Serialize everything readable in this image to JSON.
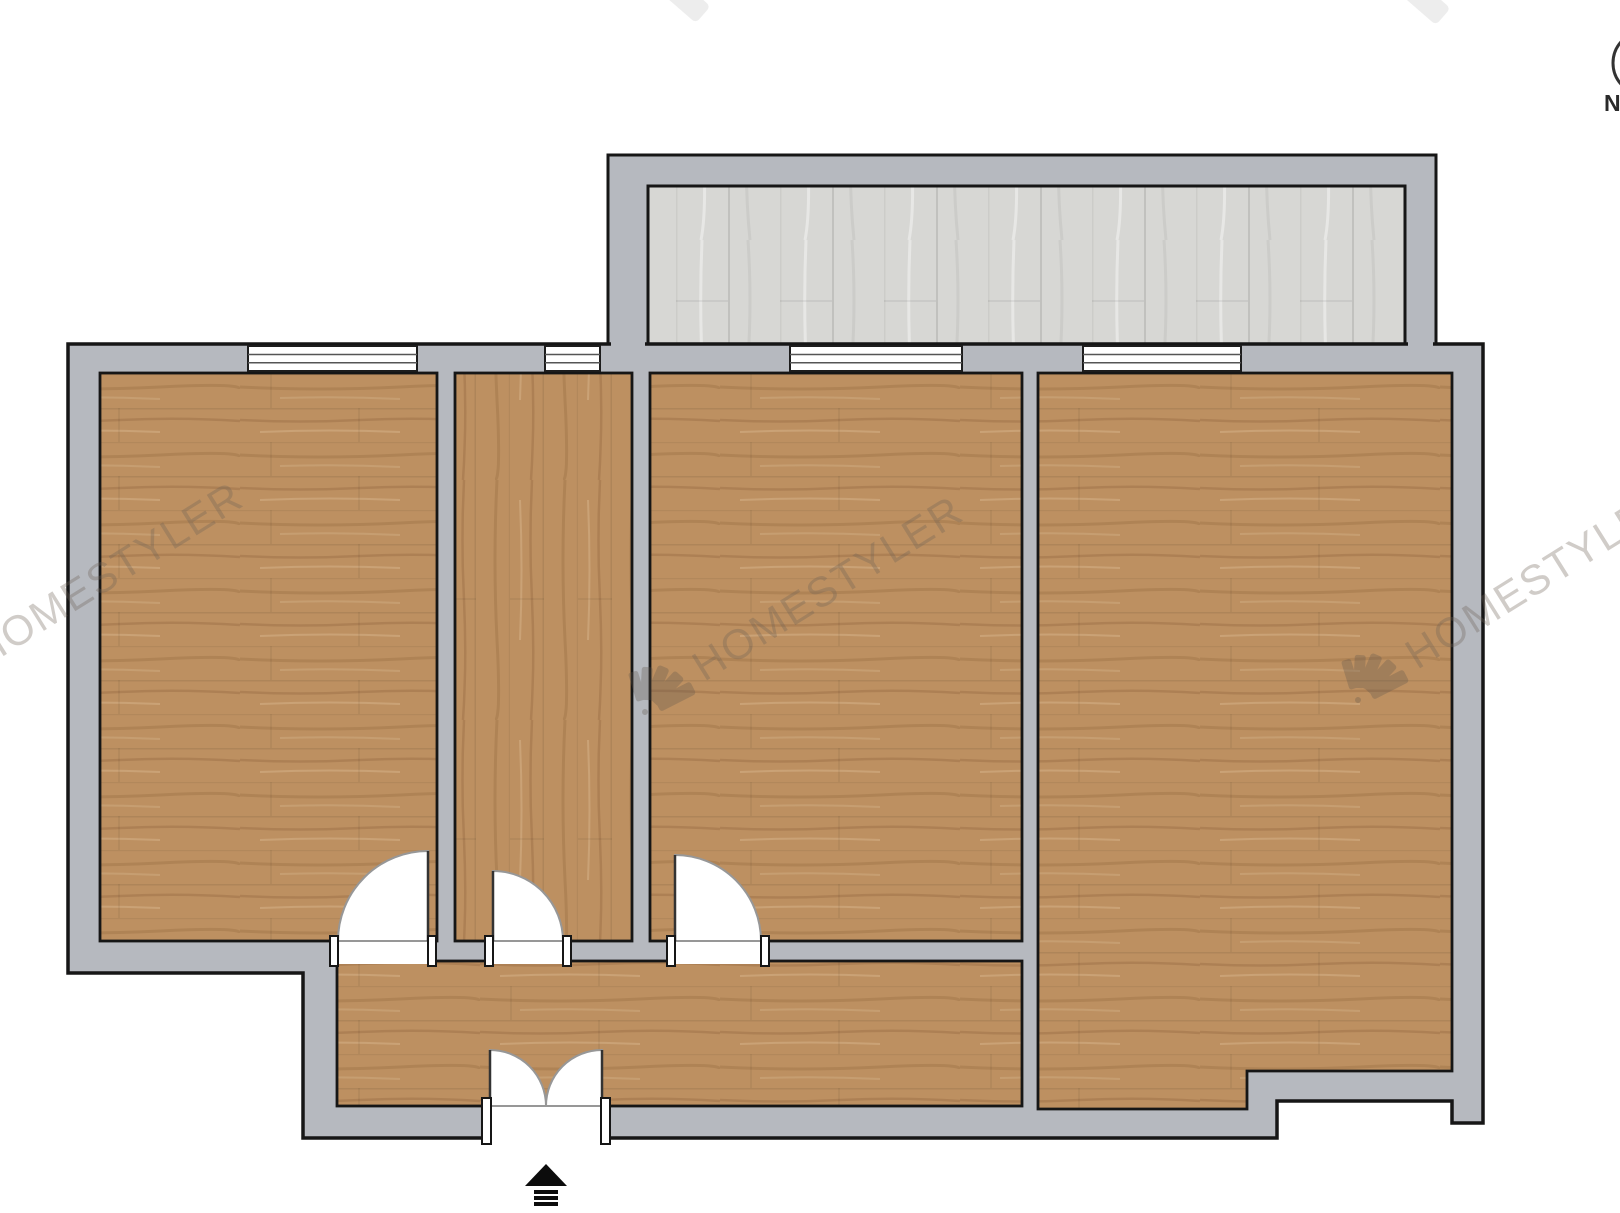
{
  "compass": {
    "label": "N"
  },
  "watermarks": {
    "left": {
      "text": "HOMESTYLER"
    },
    "center": {
      "text": "HOMESTYLER"
    },
    "right": {
      "text": "HOMESTYLER"
    }
  },
  "colors": {
    "background": "#ffffff",
    "wall_fill": "#b6b9bf",
    "outline": "#161616",
    "wood_floor": "#bd9061",
    "balcony_floor": "#d7d7d4",
    "window_fill": "#ffffff",
    "door_arc": "#979797",
    "watermark": "#6f6257"
  },
  "plan": {
    "floors": [
      {
        "id": "room-1",
        "material": "wood"
      },
      {
        "id": "room-2",
        "material": "wood"
      },
      {
        "id": "room-3",
        "material": "wood"
      },
      {
        "id": "room-4",
        "material": "wood"
      },
      {
        "id": "corridor",
        "material": "wood"
      },
      {
        "id": "balcony",
        "material": "light-wood"
      }
    ],
    "window_count": 4,
    "single_door_count": 3,
    "double_door_count": 1,
    "entrance_marker": "arrow-up"
  }
}
